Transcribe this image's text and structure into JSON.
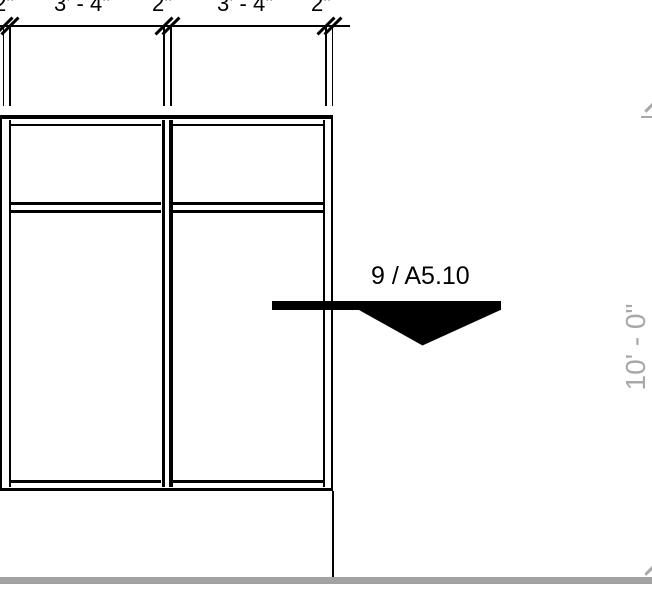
{
  "colors": {
    "background": "#ffffff",
    "line": "#000000",
    "halftone": "#a8a8a8",
    "ground": "#a2a2a2"
  },
  "top_dimension": {
    "segments": [
      {
        "label": "2\""
      },
      {
        "label": "3' - 4\""
      },
      {
        "label": "2\""
      },
      {
        "label": "3' - 4\""
      },
      {
        "label": "2\""
      }
    ]
  },
  "section_callout": {
    "label": "9 / A5.10"
  },
  "right_dimension": {
    "label": "10' - 0\""
  }
}
